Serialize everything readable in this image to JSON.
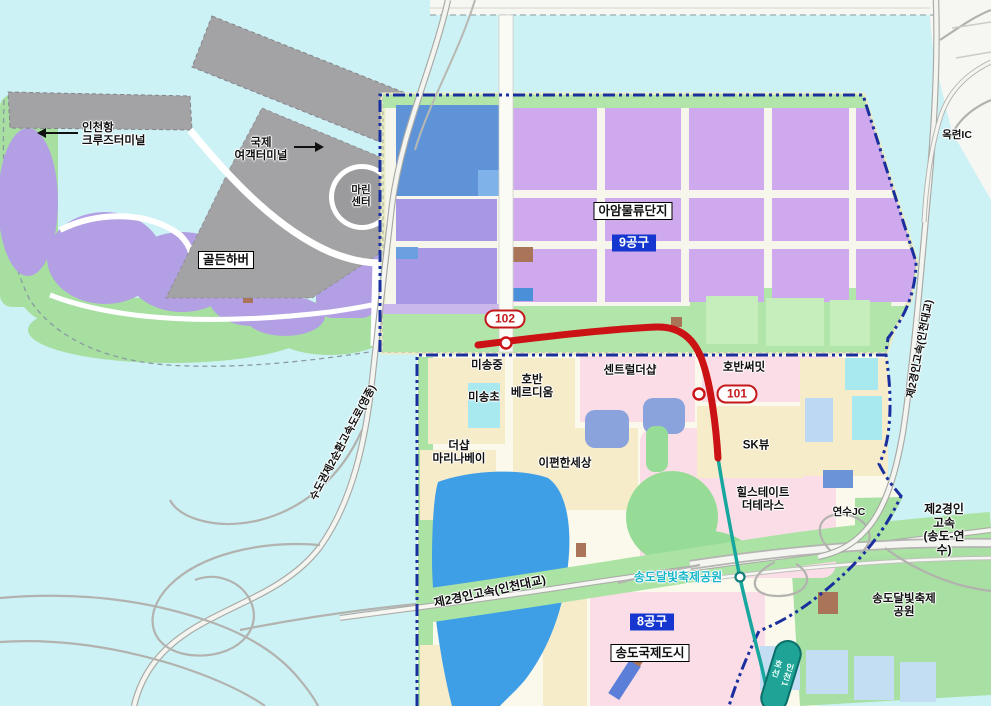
{
  "harbor": {
    "cruise_terminal": "인천항\n크루즈터미널",
    "intl_passenger_terminal": "국제\n여객터미널",
    "marine_center": "마린\n센터",
    "golden_harbor": "골든하버"
  },
  "district9": {
    "complex_name": "아암물류단지",
    "badge": "9공구"
  },
  "district8": {
    "badge": "8공구",
    "city_name": "송도국제도시"
  },
  "stations": {
    "s102": "102",
    "s101": "101",
    "line_capsule": "인천1호선"
  },
  "places": {
    "misong_middle_school": "미송중",
    "misong_elementary_school": "미송초",
    "hoban_verdium": "호반\n베르디움",
    "central_thesharp": "센트럴더샵",
    "hoban_summit": "호반써밋",
    "thesharp_marinabay": "더샵\n마리나베이",
    "epyeonhansesang": "이편한세상",
    "sk_view": "SK뷰",
    "hillstate_the_terrace": "힐스테이트\n더테라스"
  },
  "parks": {
    "moonlight_festival_park": "송도달빛축제공원",
    "moonlight_festival_park_alt": "송도달빛축제\n공원"
  },
  "roads": {
    "okryeon_ic": "옥련IC",
    "yeonsu_jc": "연수JC",
    "gyeongin2_songdo_yeonsu": "제2경인고속\n(송도-연수)",
    "gyeongin2_incheon_bridge": "제2경인고속(인천대교)",
    "gyeongin2_incheon_bridge_side": "제2경인고속(인천대교)",
    "capital_ring_expressway": "수도권제2순환고속도로(영종)"
  },
  "colors": {
    "water": "#cdf2f5",
    "red_route": "#cb1215",
    "teal_route": "#17a79e",
    "boundary_blue": "#1a2f9e",
    "district_badge_blue": "#1536cf",
    "park_label_cyan": "#18b7c8"
  }
}
